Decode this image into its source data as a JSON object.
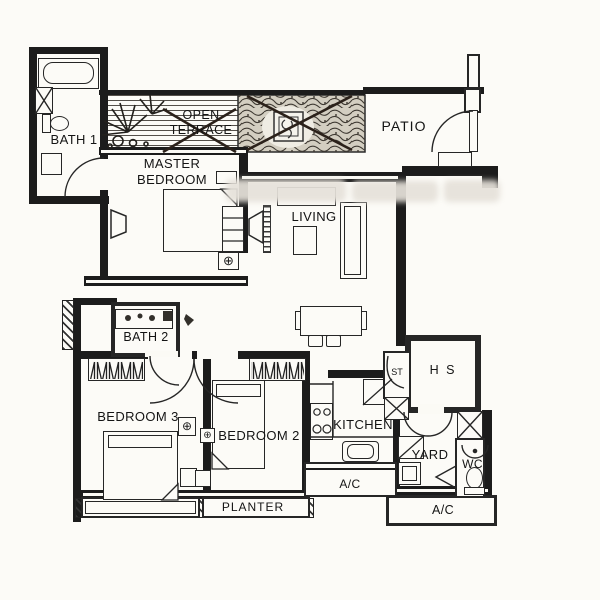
{
  "document": {
    "type": "apartment floor plan (scanned drawing)"
  },
  "colors": {
    "ink": "#1c1c1c",
    "paper": "#fbfaf5",
    "vegetation_fill": "#d3cec1"
  },
  "icons": {
    "power_point": "⊕"
  },
  "rooms": {
    "bath1": {
      "label": "BATH 1"
    },
    "master_bedroom": {
      "label": "MASTER\nBEDROOM"
    },
    "open_terrace": {
      "label": "OPEN\nTERRACE",
      "crossed_out": true
    },
    "patio": {
      "label": "PATIO"
    },
    "living": {
      "label": "LIVING"
    },
    "bath2": {
      "label": "BATH 2"
    },
    "bedroom3": {
      "label": "BEDROOM 3"
    },
    "bedroom2": {
      "label": "BEDROOM 2"
    },
    "kitchen": {
      "label": "KITCHEN"
    },
    "store": {
      "label": "ST"
    },
    "household_shelter": {
      "label": "H S"
    },
    "yard": {
      "label": "YARD"
    },
    "wc": {
      "label": "WC"
    },
    "ac_ledge_kitchen": {
      "label": "A/C"
    },
    "ac_ledge_yard": {
      "label": "A/C"
    },
    "planter": {
      "label": "PLANTER"
    },
    "planting_bed": {
      "label": "",
      "crossed_out": true
    }
  }
}
